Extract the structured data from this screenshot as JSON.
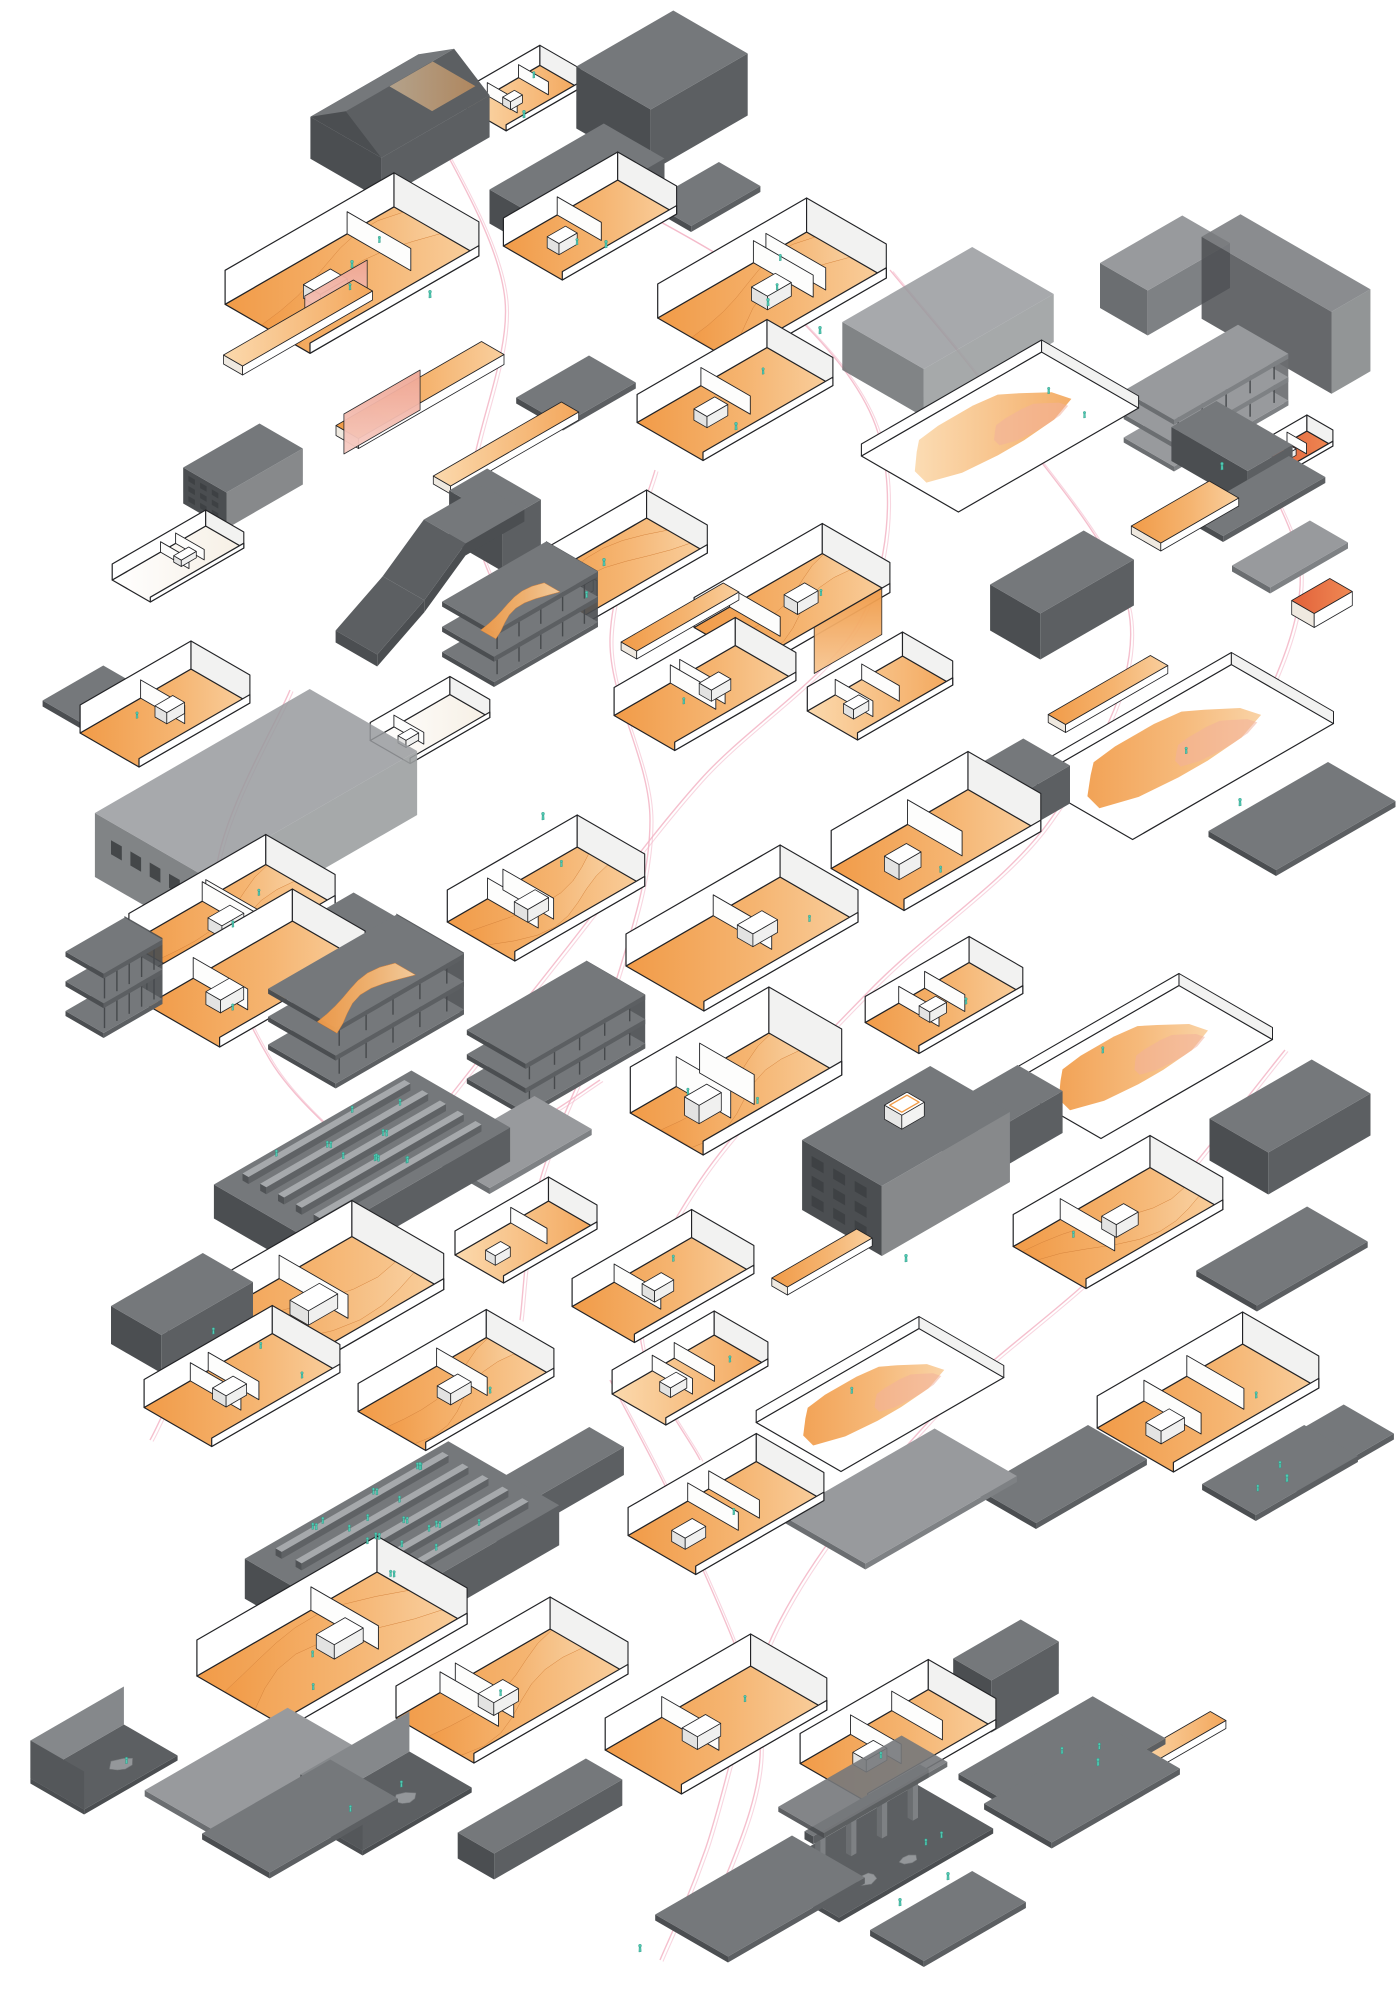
{
  "diagram": {
    "background": "#ffffff",
    "palette": {
      "ink": "#222326",
      "gray_tones": [
        [
          "#5b5e61",
          "#46494c",
          "#383a3d"
        ],
        [
          "#75787b",
          "#5c5f62",
          "#4b4e51"
        ],
        [
          "#989a9d",
          "#7e8184",
          "#6b6e71"
        ],
        [
          "#b8babc",
          "#a3a5a8",
          "#909295"
        ]
      ],
      "white": "#ffffff",
      "inner_white": "#f2f2f1",
      "orange_main": "#f19b48",
      "orange_pale": "#f9cf9e",
      "peach": "#fbd9ad",
      "salmon": "#f0ac97",
      "red_orange": "#e2613a",
      "teal": "#53cab3",
      "teal_dark": "#279380",
      "path_pink": "#f3b5c6",
      "rock_gray": "#94979a",
      "window_dark": "#3d4043"
    },
    "fragments": [
      {
        "t": "hat",
        "x": 400,
        "y": 148,
        "l": 125,
        "d": 82,
        "h": 42,
        "tone": 1,
        "rh": 26
      },
      {
        "t": "shell",
        "x": 523,
        "y": 100,
        "l": 85,
        "d": 46,
        "h": 20,
        "o": 1,
        "f": 1
      },
      {
        "t": "mass",
        "x": 662,
        "y": 122,
        "l": 112,
        "d": 86,
        "h": 62,
        "tone": 0
      },
      {
        "t": "mass",
        "x": 577,
        "y": 208,
        "l": 132,
        "d": 70,
        "h": 34,
        "tone": 1
      },
      {
        "t": "slab",
        "x": 705,
        "y": 200,
        "l": 80,
        "d": 48,
        "tone": 1
      },
      {
        "t": "shell",
        "x": 352,
        "y": 282,
        "l": 195,
        "d": 98,
        "h": 34,
        "o": 2,
        "f": 2,
        "sw": 1
      },
      {
        "t": "bar",
        "x": 298,
        "y": 332,
        "l": 150,
        "d": 22,
        "h": 9,
        "o": 1
      },
      {
        "t": "panel",
        "x": 336,
        "y": 316,
        "l": 72,
        "h": 38,
        "o": 3
      },
      {
        "t": "shell",
        "x": 590,
        "y": 232,
        "l": 132,
        "d": 68,
        "h": 28,
        "o": 2,
        "f": 1
      },
      {
        "t": "shell",
        "x": 772,
        "y": 300,
        "l": 172,
        "d": 92,
        "h": 34,
        "o": 2,
        "f": 2,
        "sw": 1
      },
      {
        "t": "mass",
        "x": 1165,
        "y": 298,
        "l": 95,
        "d": 55,
        "h": 45,
        "tone": 2
      },
      {
        "t": "mass",
        "x": 1286,
        "y": 345,
        "l": 45,
        "d": 150,
        "h": 82,
        "tone": 1,
        "ghost": 1
      },
      {
        "t": "tower",
        "x": 1206,
        "y": 424,
        "l": 132,
        "d": 58,
        "h": 52,
        "tone": 2
      },
      {
        "t": "shell",
        "x": 1300,
        "y": 452,
        "l": 46,
        "d": 30,
        "h": 16,
        "o": 4
      },
      {
        "t": "slab",
        "x": 1256,
        "y": 502,
        "l": 118,
        "d": 42,
        "tone": 1
      },
      {
        "t": "bar",
        "x": 420,
        "y": 400,
        "l": 168,
        "d": 26,
        "h": 10,
        "o": 2
      },
      {
        "t": "panel",
        "x": 382,
        "y": 432,
        "l": 88,
        "h": 40,
        "o": 3
      },
      {
        "t": "bar",
        "x": 506,
        "y": 452,
        "l": 148,
        "d": 20,
        "h": 8,
        "o": 1
      },
      {
        "t": "slab",
        "x": 576,
        "y": 396,
        "l": 84,
        "d": 54,
        "tone": 1
      },
      {
        "t": "shell",
        "x": 735,
        "y": 406,
        "l": 150,
        "d": 76,
        "h": 28,
        "o": 2,
        "f": 1
      },
      {
        "t": "mass",
        "x": 948,
        "y": 356,
        "l": 150,
        "d": 94,
        "h": 48,
        "tone": 2,
        "ghost": 1
      },
      {
        "t": "plate",
        "x": 1000,
        "y": 432,
        "l": 208,
        "d": 112,
        "h": 28,
        "o": 1,
        "f": 2
      },
      {
        "t": "win",
        "x": 243,
        "y": 494,
        "l": 88,
        "d": 50,
        "h": 36,
        "tone": 1
      },
      {
        "t": "shell",
        "x": 178,
        "y": 566,
        "l": 108,
        "d": 44,
        "h": 16,
        "o": 0
      },
      {
        "t": "ramp",
        "x": 430,
        "y": 600,
        "l": 170,
        "d": 48,
        "h": 60,
        "tone": 1
      },
      {
        "t": "mass",
        "x": 495,
        "y": 545,
        "l": 44,
        "d": 62,
        "h": 50,
        "tone": 1
      },
      {
        "t": "shell",
        "x": 612,
        "y": 575,
        "l": 150,
        "d": 70,
        "h": 28,
        "o": 2,
        "f": 1,
        "sw": 1
      },
      {
        "t": "panel",
        "x": 770,
        "y": 600,
        "l": 70,
        "h": 40,
        "o": 3
      },
      {
        "t": "bar",
        "x": 680,
        "y": 625,
        "l": 118,
        "d": 18,
        "h": 8,
        "o": 2
      },
      {
        "t": "tower",
        "x": 520,
        "y": 642,
        "l": 120,
        "d": 60,
        "h": 56,
        "tone": 1,
        "o": 1
      },
      {
        "t": "shell",
        "x": 792,
        "y": 612,
        "l": 148,
        "d": 78,
        "h": 30,
        "o": 2,
        "f": 1,
        "sw": 1
      },
      {
        "t": "panel",
        "x": 848,
        "y": 654,
        "l": 78,
        "h": 46,
        "o": 2
      },
      {
        "t": "mass",
        "x": 1062,
        "y": 618,
        "l": 108,
        "d": 58,
        "h": 46,
        "tone": 1
      },
      {
        "t": "bar",
        "x": 1185,
        "y": 520,
        "l": 90,
        "d": 34,
        "h": 8,
        "o": 2
      },
      {
        "t": "mass",
        "x": 1232,
        "y": 470,
        "l": 52,
        "d": 88,
        "h": 34,
        "tone": 1
      },
      {
        "t": "bar",
        "x": 1322,
        "y": 610,
        "l": 44,
        "d": 26,
        "h": 14,
        "o": 4
      },
      {
        "t": "slab",
        "x": 1290,
        "y": 560,
        "l": 90,
        "d": 44,
        "tone": 2
      },
      {
        "t": "shell",
        "x": 165,
        "y": 720,
        "l": 128,
        "d": 68,
        "h": 28,
        "o": 2,
        "f": 1
      },
      {
        "t": "slab",
        "x": 92,
        "y": 700,
        "l": 70,
        "d": 44,
        "tone": 1
      },
      {
        "t": "shell",
        "x": 430,
        "y": 731,
        "l": 92,
        "d": 46,
        "h": 18,
        "o": 0
      },
      {
        "t": "shell",
        "x": 705,
        "y": 700,
        "l": 140,
        "d": 70,
        "h": 28,
        "o": 2,
        "f": 1
      },
      {
        "t": "shell",
        "x": 880,
        "y": 700,
        "l": 110,
        "d": 58,
        "h": 24,
        "o": 1
      },
      {
        "t": "plate",
        "x": 1182,
        "y": 752,
        "l": 232,
        "d": 118,
        "h": 28,
        "o": 2,
        "f": 1
      },
      {
        "t": "bar",
        "x": 1108,
        "y": 698,
        "l": 118,
        "d": 20,
        "h": 8,
        "o": 2
      },
      {
        "t": "slab",
        "x": 1302,
        "y": 822,
        "l": 138,
        "d": 78,
        "tone": 1
      },
      {
        "t": "mass",
        "x": 256,
        "y": 846,
        "l": 248,
        "d": 124,
        "h": 64,
        "tone": 2,
        "ghost": 1,
        "win": 1
      },
      {
        "t": "shell",
        "x": 232,
        "y": 926,
        "l": 158,
        "d": 80,
        "h": 30,
        "o": 2,
        "f": 2,
        "sw": 1
      },
      {
        "t": "shell",
        "x": 546,
        "y": 906,
        "l": 150,
        "d": 78,
        "h": 32,
        "o": 2,
        "f": 1,
        "sw": 1
      },
      {
        "t": "shell",
        "x": 742,
        "y": 946,
        "l": 178,
        "d": 90,
        "h": 32,
        "o": 2,
        "f": 1
      },
      {
        "t": "shell",
        "x": 936,
        "y": 852,
        "l": 158,
        "d": 84,
        "h": 38,
        "o": 2,
        "f": 1
      },
      {
        "t": "mass",
        "x": 1012,
        "y": 810,
        "l": 80,
        "d": 54,
        "h": 38,
        "tone": 1
      },
      {
        "t": "tower",
        "x": 114,
        "y": 1010,
        "l": 68,
        "d": 44,
        "h": 66,
        "tone": 0
      },
      {
        "t": "shell",
        "x": 256,
        "y": 986,
        "l": 168,
        "d": 84,
        "h": 32,
        "o": 2,
        "f": 1
      },
      {
        "t": "slab",
        "x": 332,
        "y": 940,
        "l": 108,
        "d": 58,
        "tone": 1
      },
      {
        "t": "tower",
        "x": 366,
        "y": 1032,
        "l": 148,
        "d": 78,
        "h": 62,
        "tone": 1,
        "o": 1
      },
      {
        "t": "tower",
        "x": 556,
        "y": 1066,
        "l": 138,
        "d": 68,
        "h": 54,
        "tone": 1
      },
      {
        "t": "shell",
        "x": 736,
        "y": 1096,
        "l": 160,
        "d": 84,
        "h": 46,
        "o": 2,
        "f": 2,
        "sw": 1
      },
      {
        "t": "shell",
        "x": 944,
        "y": 1010,
        "l": 120,
        "d": 62,
        "h": 26,
        "o": 2,
        "f": 1
      },
      {
        "t": "plate",
        "x": 1140,
        "y": 1062,
        "l": 198,
        "d": 108,
        "h": 30,
        "o": 2,
        "f": 1
      },
      {
        "t": "mass",
        "x": 1290,
        "y": 1148,
        "l": 118,
        "d": 68,
        "h": 42,
        "tone": 1
      },
      {
        "t": "rows",
        "x": 362,
        "y": 1190,
        "l": 228,
        "d": 114,
        "h": 34,
        "tone": 1,
        "f": 10
      },
      {
        "t": "slab",
        "x": 512,
        "y": 1148,
        "l": 118,
        "d": 66,
        "tone": 2
      },
      {
        "t": "shell",
        "x": 306,
        "y": 1318,
        "l": 212,
        "d": 106,
        "h": 36,
        "o": 2,
        "f": 2,
        "sw": 1
      },
      {
        "t": "mass",
        "x": 182,
        "y": 1332,
        "l": 106,
        "d": 58,
        "h": 38,
        "tone": 1
      },
      {
        "t": "shell",
        "x": 526,
        "y": 1244,
        "l": 108,
        "d": 56,
        "h": 24,
        "o": 1
      },
      {
        "t": "shell",
        "x": 663,
        "y": 1292,
        "l": 138,
        "d": 72,
        "h": 28,
        "o": 2,
        "f": 1
      },
      {
        "t": "win",
        "x": 906,
        "y": 1196,
        "l": 148,
        "d": 92,
        "h": 70,
        "tone": 1
      },
      {
        "t": "mass",
        "x": 1002,
        "y": 1142,
        "l": 88,
        "d": 52,
        "h": 42,
        "tone": 1
      },
      {
        "t": "shell",
        "x": 1118,
        "y": 1230,
        "l": 158,
        "d": 84,
        "h": 32,
        "o": 2,
        "f": 1,
        "sw": 1
      },
      {
        "t": "slab",
        "x": 1282,
        "y": 1262,
        "l": 128,
        "d": 70,
        "tone": 1
      },
      {
        "t": "bar",
        "x": 822,
        "y": 1266,
        "l": 98,
        "d": 18,
        "h": 8,
        "o": 2
      },
      {
        "t": "shell",
        "x": 242,
        "y": 1392,
        "l": 148,
        "d": 78,
        "h": 28,
        "o": 2,
        "f": 1
      },
      {
        "t": "shell",
        "x": 456,
        "y": 1396,
        "l": 148,
        "d": 78,
        "h": 28,
        "o": 2,
        "f": 1,
        "sw": 1
      },
      {
        "t": "shell",
        "x": 690,
        "y": 1382,
        "l": 118,
        "d": 62,
        "h": 24,
        "o": 1,
        "f": 1
      },
      {
        "t": "plate",
        "x": 880,
        "y": 1400,
        "l": 188,
        "d": 98,
        "h": 28,
        "o": 2,
        "f": 1
      },
      {
        "t": "shell",
        "x": 1208,
        "y": 1410,
        "l": 168,
        "d": 88,
        "h": 32,
        "o": 2,
        "f": 1
      },
      {
        "t": "slab",
        "x": 1322,
        "y": 1452,
        "l": 108,
        "d": 58,
        "tone": 1
      },
      {
        "t": "mass",
        "x": 546,
        "y": 1500,
        "l": 140,
        "d": 40,
        "h": 28,
        "tone": 1
      },
      {
        "t": "shell",
        "x": 726,
        "y": 1520,
        "l": 148,
        "d": 78,
        "h": 28,
        "o": 2,
        "f": 1
      },
      {
        "t": "slab",
        "x": 900,
        "y": 1502,
        "l": 175,
        "d": 95,
        "tone": 2
      },
      {
        "t": "slab",
        "x": 1062,
        "y": 1480,
        "l": 128,
        "d": 68,
        "tone": 1
      },
      {
        "t": "slab",
        "x": 1280,
        "y": 1476,
        "l": 118,
        "d": 62,
        "tone": 1,
        "f": 1
      },
      {
        "t": "rows",
        "x": 402,
        "y": 1572,
        "l": 235,
        "d": 128,
        "h": 40,
        "tone": 0,
        "f": 16
      },
      {
        "t": "shell",
        "x": 332,
        "y": 1652,
        "l": 208,
        "d": 104,
        "h": 36,
        "o": 2,
        "f": 2,
        "sw": 1
      },
      {
        "t": "shell",
        "x": 512,
        "y": 1698,
        "l": 178,
        "d": 90,
        "h": 32,
        "o": 2,
        "f": 1,
        "sw": 1
      },
      {
        "t": "shell",
        "x": 716,
        "y": 1732,
        "l": 168,
        "d": 88,
        "h": 32,
        "o": 2,
        "f": 1
      },
      {
        "t": "shell",
        "x": 898,
        "y": 1748,
        "l": 148,
        "d": 78,
        "h": 30,
        "o": 2,
        "f": 1
      },
      {
        "t": "mass",
        "x": 1006,
        "y": 1702,
        "l": 78,
        "d": 44,
        "h": 52,
        "tone": 1
      },
      {
        "t": "slab",
        "x": 1062,
        "y": 1762,
        "l": 155,
        "d": 84,
        "tone": 1,
        "f": 1
      },
      {
        "t": "room",
        "x": 104,
        "y": 1772,
        "l": 108,
        "d": 62,
        "h": 38,
        "tone": 1,
        "f": 1
      },
      {
        "t": "slab",
        "x": 256,
        "y": 1778,
        "l": 165,
        "d": 92,
        "tone": 2
      },
      {
        "t": "slab",
        "x": 300,
        "y": 1822,
        "l": 148,
        "d": 78,
        "tone": 1
      },
      {
        "t": "room",
        "x": 386,
        "y": 1806,
        "l": 126,
        "d": 72,
        "h": 40,
        "tone": 1,
        "f": 2
      },
      {
        "t": "mass",
        "x": 540,
        "y": 1832,
        "l": 148,
        "d": 42,
        "h": 26,
        "tone": 1
      },
      {
        "t": "frame",
        "x": 878,
        "y": 1856,
        "l": 178,
        "d": 88,
        "h": 44,
        "tone": 1,
        "f": 2
      },
      {
        "t": "slab",
        "x": 1082,
        "y": 1792,
        "l": 148,
        "d": 78,
        "tone": 1
      },
      {
        "t": "bar",
        "x": 1180,
        "y": 1746,
        "l": 88,
        "d": 18,
        "h": 8,
        "o": 1
      },
      {
        "t": "slab",
        "x": 760,
        "y": 1902,
        "l": 158,
        "d": 84,
        "tone": 1
      },
      {
        "t": "slab",
        "x": 948,
        "y": 1922,
        "l": 118,
        "d": 62,
        "tone": 0
      }
    ],
    "extra_figures": [
      [
        524,
        118
      ],
      [
        352,
        268
      ],
      [
        430,
        298
      ],
      [
        606,
        248
      ],
      [
        768,
        306
      ],
      [
        820,
        334
      ],
      [
        1222,
        470
      ],
      [
        736,
        430
      ],
      [
        604,
        566
      ],
      [
        543,
        820
      ],
      [
        1240,
        806
      ],
      [
        906,
        1262
      ],
      [
        1287,
        1482
      ],
      [
        1098,
        1766
      ],
      [
        948,
        1880
      ],
      [
        640,
        1952
      ],
      [
        900,
        1906
      ],
      [
        420,
        1470
      ]
    ],
    "circulation_paths": [
      [
        [
          640,
          210
        ],
        [
          780,
          300
        ],
        [
          880,
          440
        ],
        [
          860,
          620
        ],
        [
          700,
          780
        ],
        [
          565,
          950
        ],
        [
          435,
          1115
        ]
      ],
      [
        [
          890,
          270
        ],
        [
          1010,
          420
        ],
        [
          1130,
          620
        ],
        [
          1050,
          820
        ],
        [
          870,
          990
        ],
        [
          700,
          1180
        ],
        [
          640,
          1330
        ],
        [
          700,
          1460
        ]
      ],
      [
        [
          655,
          470
        ],
        [
          610,
          640
        ],
        [
          650,
          820
        ],
        [
          610,
          1000
        ],
        [
          540,
          1180
        ],
        [
          520,
          1320
        ]
      ],
      [
        [
          150,
          1440
        ],
        [
          230,
          1300
        ],
        [
          380,
          1190
        ],
        [
          520,
          1130
        ],
        [
          600,
          1080
        ]
      ],
      [
        [
          290,
          690
        ],
        [
          215,
          880
        ],
        [
          270,
          1060
        ],
        [
          400,
          1190
        ]
      ],
      [
        [
          1285,
          1050
        ],
        [
          1120,
          1250
        ],
        [
          930,
          1420
        ],
        [
          780,
          1620
        ],
        [
          705,
          1850
        ],
        [
          660,
          1960
        ]
      ],
      [
        [
          610,
          1380
        ],
        [
          690,
          1540
        ],
        [
          760,
          1740
        ],
        [
          715,
          1905
        ]
      ],
      [
        [
          435,
          130
        ],
        [
          505,
          300
        ],
        [
          470,
          500
        ],
        [
          520,
          640
        ]
      ],
      [
        [
          1235,
          425
        ],
        [
          1300,
          570
        ],
        [
          1255,
          720
        ],
        [
          1180,
          800
        ]
      ]
    ]
  }
}
